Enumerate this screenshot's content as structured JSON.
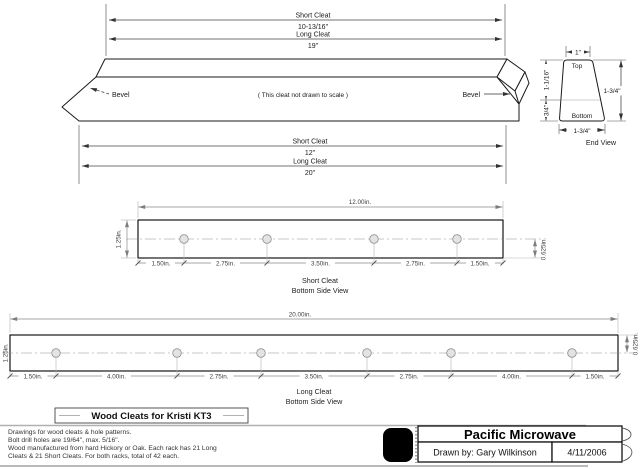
{
  "drawing": {
    "dims_top": {
      "short_label": "Short Cleat",
      "short_value": "10-13/16\"",
      "long_label": "Long Cleat",
      "long_value": "19\""
    },
    "cleat3d": {
      "bevel_left": "Bevel",
      "bevel_right": "Bevel",
      "note": "( This cleat not drawn to scale )"
    },
    "dims_overall": {
      "short_label": "Short Cleat",
      "short_value": "12\"",
      "long_label": "Long Cleat",
      "long_value": "20\""
    },
    "end_view": {
      "caption": "End View",
      "top_label": "Top",
      "bottom_label": "Bottom",
      "top_width": "1\"",
      "bottom_width": "1-3/4\"",
      "height": "1-3/4\"",
      "upper_height": "1-1/16\"",
      "lower_height": "3/4\""
    },
    "short_view": {
      "caption1": "Short Cleat",
      "caption2": "Bottom Side View",
      "length": "12.00in.",
      "width": "1.25in.",
      "hole_offset": "0.625in.",
      "chain": [
        "1.50in.",
        "2.75in.",
        "3.50in.",
        "2.75in.",
        "1.50in."
      ]
    },
    "long_view": {
      "caption1": "Long Cleat",
      "caption2": "Bottom Side View",
      "length": "20.00in.",
      "width": "1.25in.",
      "hole_offset": "0.625in.",
      "chain": [
        "1.50in.",
        "4.00in.",
        "2.75in.",
        "3.50in.",
        "2.75in.",
        "4.00in.",
        "1.50in."
      ]
    }
  },
  "title_block": {
    "title": "Wood Cleats for Kristi KT3",
    "notes": [
      "Drawings for wood cleats & hole patterns.",
      "Bolt drill holes are 19/64\", max. 5/16\".",
      "Wood manufactured from hard Hickory or Oak. Each rack has 21 Long",
      "Cleats & 21 Short Cleats.  For both racks, total of 42 each."
    ]
  },
  "company_block": {
    "company": "Pacific Microwave",
    "drawn_by": "Drawn by: Gary Wilkinson",
    "date": "4/11/2006"
  }
}
